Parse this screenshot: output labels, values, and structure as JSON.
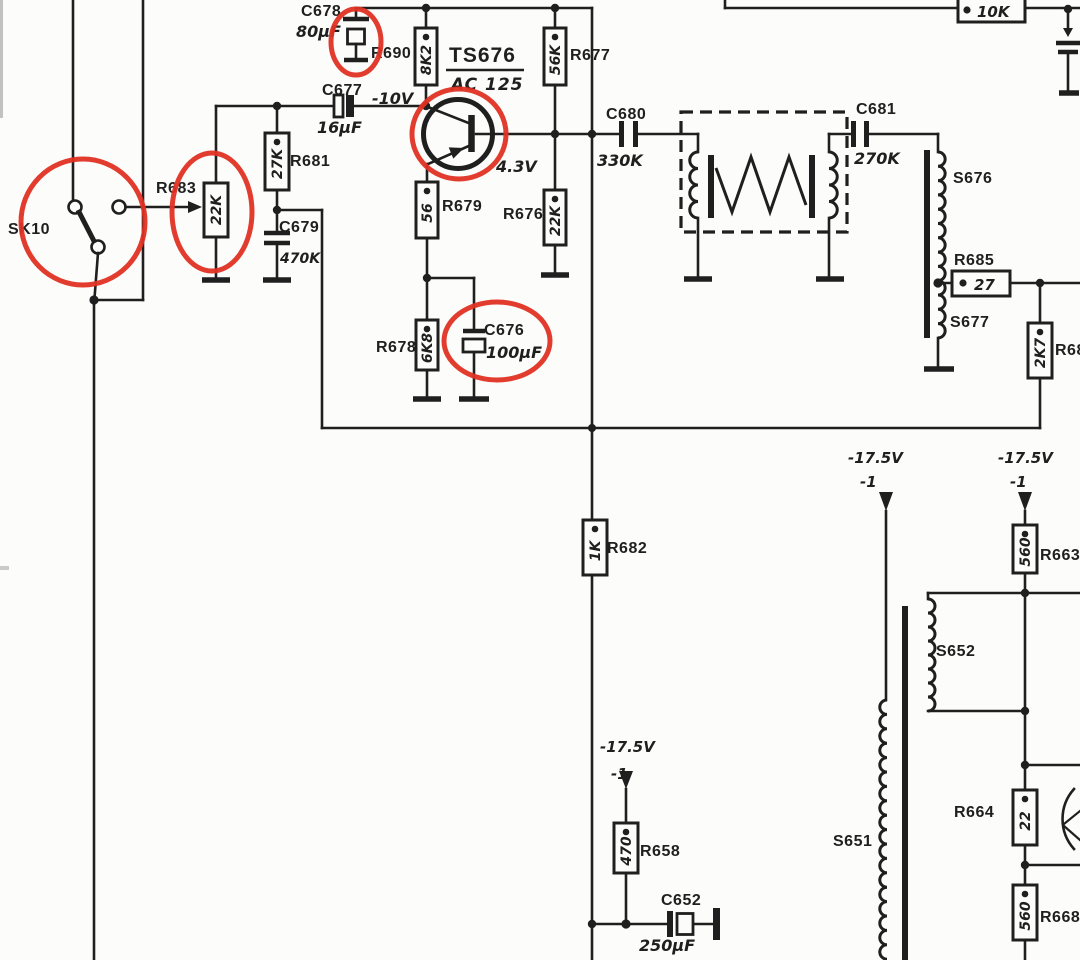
{
  "colors": {
    "ink": "#1f1f1f",
    "annotation_red": "#e03224",
    "paper": "#fcfcfa"
  },
  "components": {
    "sk10": {
      "label": "SK10"
    },
    "r683": {
      "label": "R683",
      "value": "22K"
    },
    "r681": {
      "label": "R681",
      "value": "27K"
    },
    "c679": {
      "label": "C679",
      "value": "470K"
    },
    "c677": {
      "label": "C677",
      "value": "16µF"
    },
    "c678": {
      "label": "C678",
      "value": "80µF"
    },
    "r690": {
      "label": "R690",
      "value": "8K2"
    },
    "ts676": {
      "ref": "TS676",
      "part": "AC 125",
      "collector_voltage": "-10V",
      "emitter_voltage": "4.3V"
    },
    "r677": {
      "label": "R677",
      "value": "56K"
    },
    "r679": {
      "label": "R679",
      "value": "56"
    },
    "r676": {
      "label": "R676",
      "value": "22K"
    },
    "r678": {
      "label": "R678",
      "value": "6K8"
    },
    "c676": {
      "label": "C676",
      "value": "100µF"
    },
    "c680": {
      "label": "C680",
      "value": "330K"
    },
    "c681": {
      "label": "C681",
      "value": "270K"
    },
    "s676": {
      "label": "S676"
    },
    "s677": {
      "label": "S677"
    },
    "r685": {
      "label": "R685",
      "value": "27"
    },
    "r68x": {
      "label": "R68",
      "value": "2K7"
    },
    "r10k": {
      "value": "10K"
    },
    "r682": {
      "label": "R682",
      "value": "1K"
    },
    "r658": {
      "label": "R658",
      "value": "470"
    },
    "c652": {
      "label": "C652",
      "value": "250µF"
    },
    "s651": {
      "label": "S651"
    },
    "s652": {
      "label": "S652"
    },
    "r663": {
      "label": "R663",
      "value": "560"
    },
    "r664": {
      "label": "R664",
      "value": "22"
    },
    "r668": {
      "label": "R668",
      "value": "560"
    }
  },
  "annotations": {
    "supply_voltage": "-17.5V",
    "supply_tap": "-1"
  }
}
